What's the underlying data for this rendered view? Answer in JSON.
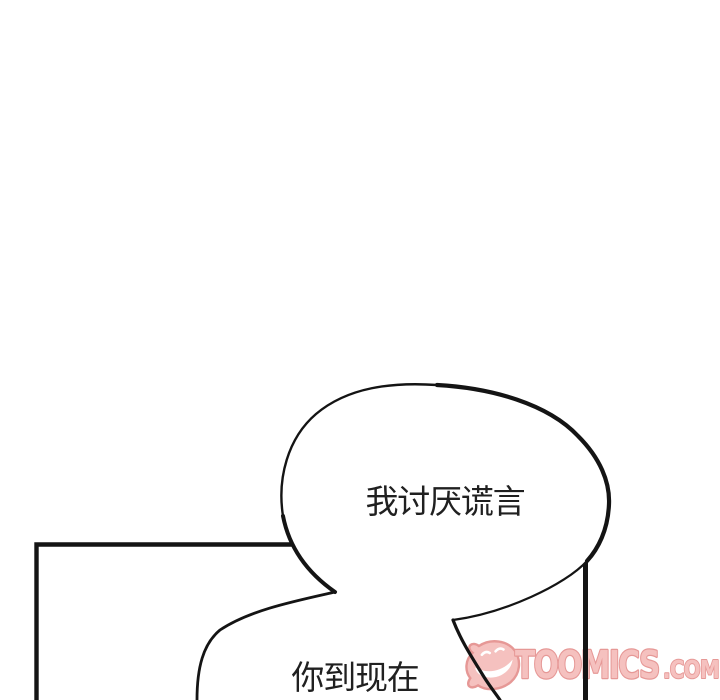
{
  "artwork": {
    "bubble1": {
      "text": "我讨厌谎言"
    },
    "bubble2": {
      "text": "你到现在"
    },
    "watermark": {
      "brand": "TOOMICS",
      "tld": ".COM",
      "fill_color": "#f4b4b1",
      "outline_color": "#e18280"
    },
    "colors": {
      "background": "#ffffff",
      "ink": "#141414",
      "dialogue_text": "#202020"
    }
  }
}
